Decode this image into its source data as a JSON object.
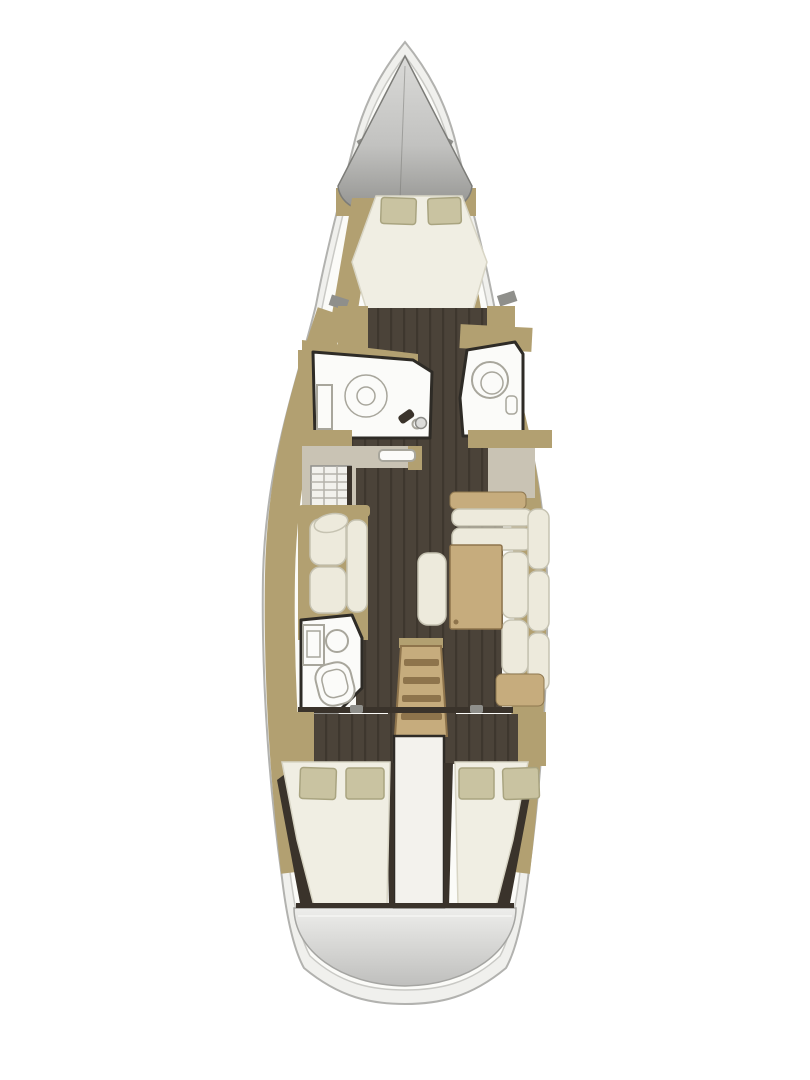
{
  "figure": {
    "kind": "yacht-floor-plan",
    "view": "top-down",
    "orientation": "bow-up",
    "hull_count": 1
  },
  "palette": {
    "hull_ring": "#f0f0ed",
    "hull_stroke": "#b2b2af",
    "hull_inner": "#c9c9c5",
    "deck": "#fbfbf8",
    "cone_light": "#dadad8",
    "cone_dark": "#8e8e8b",
    "wood": "#b2a071",
    "wood_light": "#c6ac7d",
    "wood_dark": "#8e744c",
    "floor": "#4b4339",
    "floor_line": "#3e372e",
    "mattress": "#f0eee3",
    "mattress_edge": "#d8d5c5",
    "pillow": "#c9c3a1",
    "pillow_edge": "#a9a480",
    "cushion": "#edeadc",
    "cushion_edge": "#c6c3b2",
    "counter": "#c9c3b4",
    "bath_wall": "#2e2b26",
    "fixture_white": "#fbfbf9",
    "fixture_stroke": "#a8a69c",
    "dark_trim": "#3a332b",
    "vent_gray": "#8f8f8b",
    "engine": "#f3f2ed",
    "platform_light": "#ededeb",
    "platform_dark": "#bfbfbd"
  },
  "areas": {
    "bow": {
      "features": [
        "anchor-locker-cone"
      ]
    },
    "forward_cabin": {
      "double_berths": 1,
      "pillows": 2,
      "side_shelves": 2
    },
    "forward_head_port": {
      "fixtures": [
        "shower-circle",
        "tall-locker",
        "faucet"
      ]
    },
    "forward_head_starboard": {
      "fixtures": [
        "round-bowl",
        "wall-unit"
      ]
    },
    "galley_port": {
      "fixtures": [
        "l-counter",
        "stove-grid",
        "sink"
      ]
    },
    "nav_station_starboard": {
      "fixtures": [
        "chart-table"
      ]
    },
    "salon": {
      "port_settee_cushions": 2,
      "starboard_sofa_shape": "L",
      "table": 1,
      "bench": 1
    },
    "aft_head_port": {
      "fixtures": [
        "sink-circle",
        "toilet",
        "cabinet"
      ]
    },
    "companionway": {
      "steps": 4
    },
    "aft_cabin_port": {
      "double_berths": 1,
      "pillows": 2
    },
    "aft_cabin_starboard": {
      "double_berths": 1,
      "pillows": 2
    },
    "stern": {
      "features": [
        "swim-platform"
      ]
    },
    "totals": {
      "cabins": 3,
      "heads": 3,
      "pillows": 6
    }
  }
}
